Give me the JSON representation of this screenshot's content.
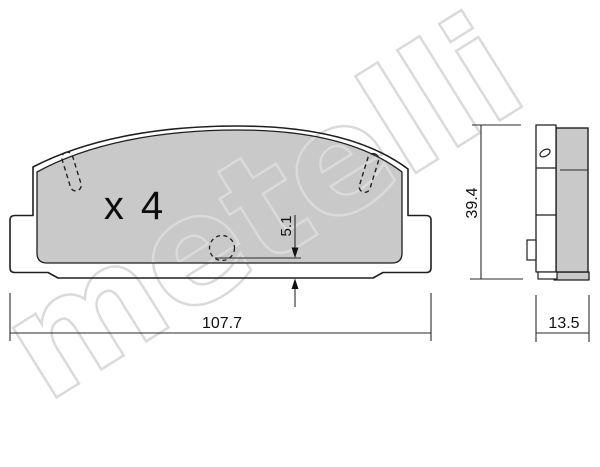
{
  "watermark": {
    "text": "metelli"
  },
  "front_view": {
    "quantity_label": "x 4"
  },
  "dimensions": {
    "overall_width_mm": "107.7",
    "overall_height_mm": "39.4",
    "thickness_mm": "13.5",
    "sensor_offset_mm": "5.1"
  },
  "colors": {
    "friction_material": "#c9c9c9",
    "outline": "#1f1f1f",
    "dimension_lines": "#2a2a2a",
    "watermark": "#dadada",
    "background": "#ffffff"
  }
}
